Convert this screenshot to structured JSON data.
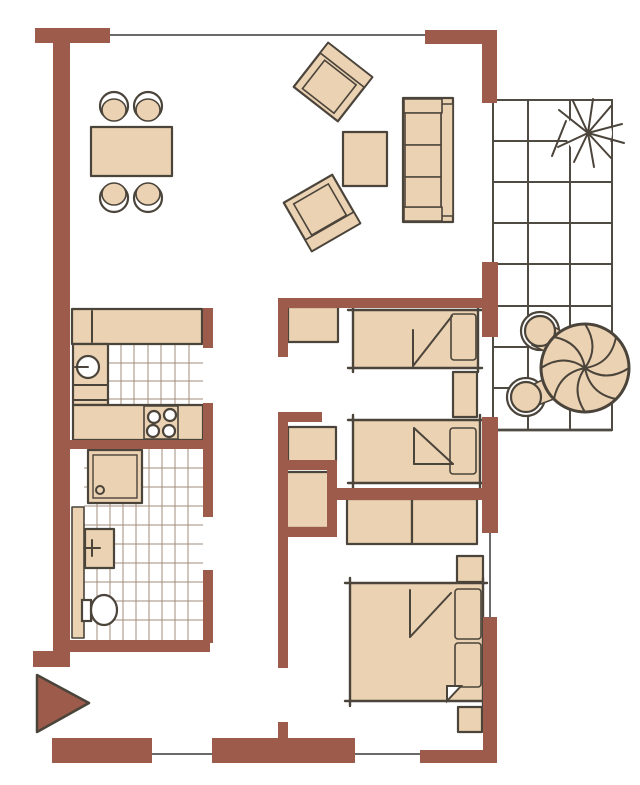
{
  "meta": {
    "type": "architectural-floor-plan",
    "description": "Hand-drawn style apartment floor plan with living-dining area, open kitchen, bathroom, hallway, two single bedrooms, one double bedroom, and a tiled balcony with seating; entrance arrow at lower left",
    "visible_text": ""
  },
  "colors": {
    "wall": "#9C5B4B",
    "furniture": "#EBD2B2",
    "outline": "#4B443B",
    "window": "#6A6A6A",
    "tile": "#A18D7C",
    "grid": "#4F4A42",
    "background": "#FFFFFF"
  },
  "rooms": [
    {
      "id": "dining-area",
      "name": "Dining area",
      "furniture": [
        "rectangular dining table",
        "4 chairs"
      ]
    },
    {
      "id": "living-area",
      "name": "Living area",
      "furniture": [
        "three-seat sofa",
        "2 rotated armchairs",
        "coffee table"
      ]
    },
    {
      "id": "kitchen",
      "name": "Kitchen",
      "furniture": [
        "upper counter",
        "side counter with round sink",
        "lower counter with 4-burner stove",
        "tiled floor"
      ]
    },
    {
      "id": "bathroom",
      "name": "Bathroom",
      "furniture": [
        "shower tray with drain",
        "tall cabinet",
        "washbasin with faucet",
        "toilet",
        "tiled floor"
      ]
    },
    {
      "id": "hallway",
      "name": "Hallway",
      "furniture": []
    },
    {
      "id": "bedroom-1",
      "name": "Single bedroom 1",
      "furniture": [
        "single bed with pillow and folded blanket",
        "dresser",
        "nightstand"
      ]
    },
    {
      "id": "bedroom-2",
      "name": "Single bedroom 2",
      "furniture": [
        "single bed with pillow and folded blanket",
        "dresser",
        "built-in closet niche"
      ]
    },
    {
      "id": "bedroom-master",
      "name": "Double bedroom",
      "furniture": [
        "double bed with two pillows",
        "2 nightstands",
        "two-section wardrobe"
      ]
    },
    {
      "id": "balcony",
      "name": "Balcony",
      "furniture": [
        "round table with parasol segments",
        "2 round chairs",
        "sun symbol",
        "tile grid floor"
      ]
    },
    {
      "id": "entrance",
      "name": "Entrance",
      "furniture": [
        "entry direction arrow"
      ]
    }
  ]
}
